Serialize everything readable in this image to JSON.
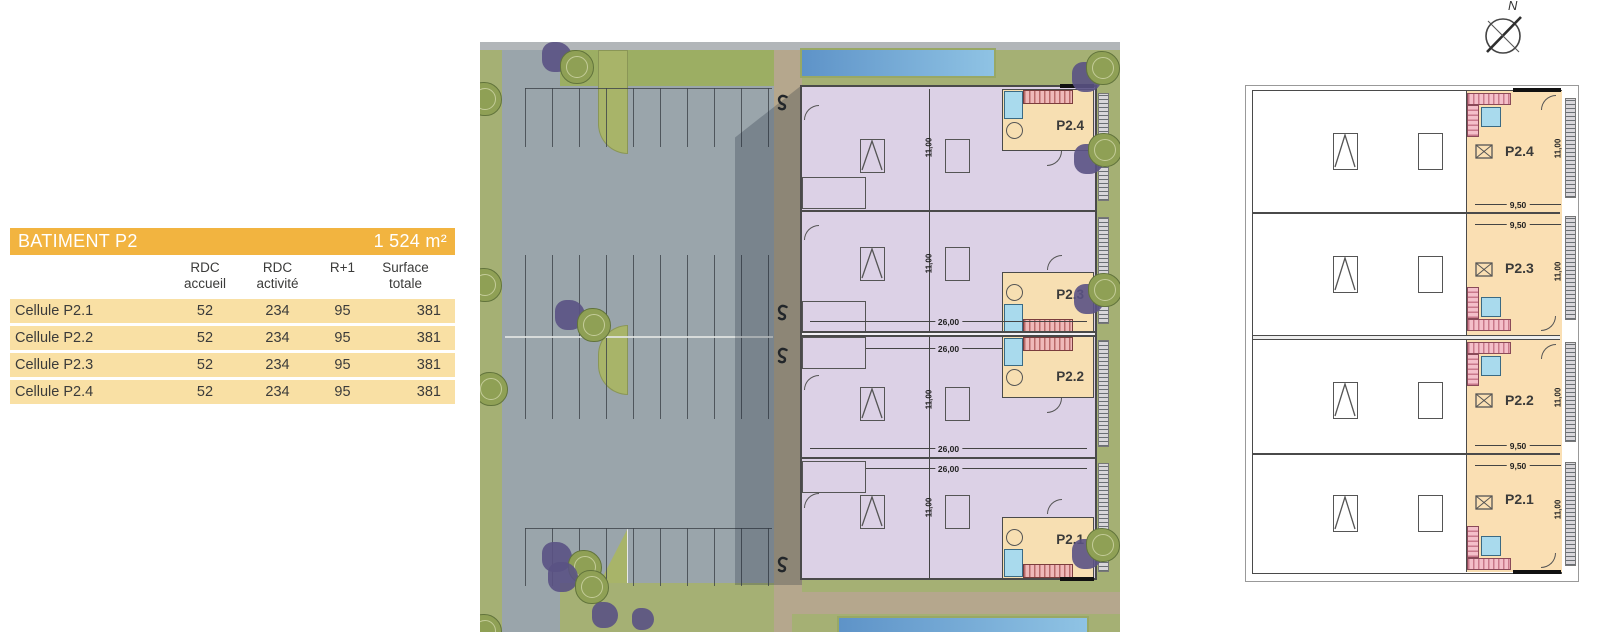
{
  "table": {
    "title": "BATIMENT P2",
    "total_area": "1 524 m²",
    "columns": [
      "RDC\naccueil",
      "RDC\nactivité",
      "R+1",
      "Surface\ntotale"
    ],
    "rows": [
      {
        "label": "Cellule P2.1",
        "values": [
          "52",
          "234",
          "95",
          "381"
        ]
      },
      {
        "label": "Cellule P2.2",
        "values": [
          "52",
          "234",
          "95",
          "381"
        ]
      },
      {
        "label": "Cellule P2.3",
        "values": [
          "52",
          "234",
          "95",
          "381"
        ]
      },
      {
        "label": "Cellule P2.4",
        "values": [
          "52",
          "234",
          "95",
          "381"
        ]
      }
    ]
  },
  "site_plan": {
    "dims": {
      "width": "26,00",
      "height": "11,00"
    },
    "cells": [
      {
        "label": "P2.4"
      },
      {
        "label": "P2.3"
      },
      {
        "label": "P2.2"
      },
      {
        "label": "P2.1"
      }
    ]
  },
  "floor_plan": {
    "dims": {
      "width": "9,50",
      "height": "11,00"
    },
    "cells": [
      {
        "label": "P2.4"
      },
      {
        "label": "P2.3"
      },
      {
        "label": "P2.2"
      },
      {
        "label": "P2.1"
      }
    ]
  },
  "compass": {
    "north": "N"
  },
  "colors": {
    "table_header": "#F2B440",
    "table_row": "#F9E0A4",
    "accueil_room": "#F7DFB2",
    "activity_area": "#DCD1E6",
    "r1_room": "#FADFB3",
    "water": "#5E93C8",
    "grass": "#A5B074",
    "road": "#9AA5AB",
    "stairs": "#EFB9B9",
    "sanitary": "#A9DAED"
  }
}
